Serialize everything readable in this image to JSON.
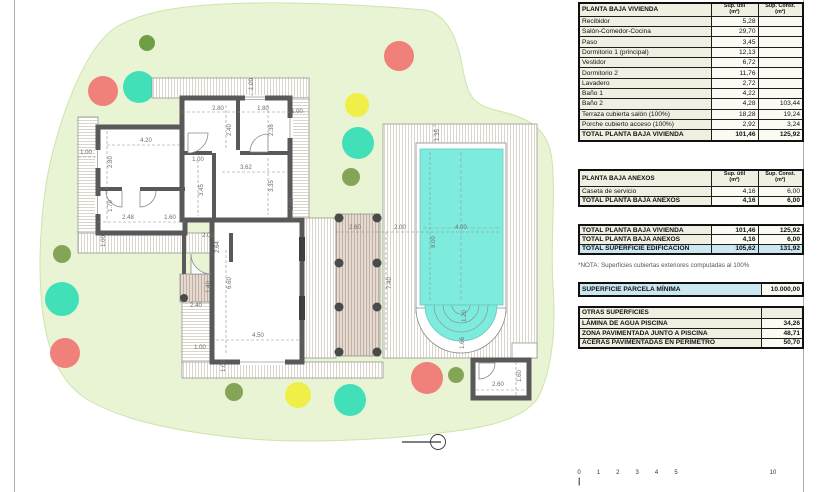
{
  "colors": {
    "site_green": "#e8f4d3",
    "site_edge": "#cfe3ae",
    "wall_gray": "#595959",
    "pool_water": "#7debde",
    "deck_line": "#d8d1c6",
    "pergola_bg": "#e4dad1",
    "pergola_line": "#bdab9e",
    "highlight_blue": "#cbe7f1",
    "table_cream": "#f0efe2",
    "tree_red": "#f0807a",
    "tree_teal": "#41e0b9",
    "tree_yellow": "#f0ee49",
    "tree_olive": "#84a558",
    "tree_olive_dark": "#6f9e45"
  },
  "plan": {
    "dimensions": [
      {
        "t": "1.00",
        "x": 252,
        "y": 84,
        "v": true
      },
      {
        "t": "2.80",
        "x": 218,
        "y": 109,
        "v": false
      },
      {
        "t": "1.80",
        "x": 263,
        "y": 109,
        "v": false
      },
      {
        "t": "1.00",
        "x": 297,
        "y": 112,
        "v": false
      },
      {
        "t": "2.40",
        "x": 230,
        "y": 130,
        "v": true
      },
      {
        "t": "2.38",
        "x": 272,
        "y": 130,
        "v": true
      },
      {
        "t": "4.20",
        "x": 146,
        "y": 141,
        "v": false
      },
      {
        "t": "1.00",
        "x": 86,
        "y": 153,
        "v": false
      },
      {
        "t": "2.80",
        "x": 111,
        "y": 162,
        "v": true
      },
      {
        "t": "1.00",
        "x": 198,
        "y": 160,
        "v": false
      },
      {
        "t": "3.62",
        "x": 246,
        "y": 168,
        "v": false
      },
      {
        "t": "3.45",
        "x": 202,
        "y": 190,
        "v": true
      },
      {
        "t": "3.35",
        "x": 272,
        "y": 186,
        "v": true
      },
      {
        "t": "1.70",
        "x": 111,
        "y": 206,
        "v": true
      },
      {
        "t": "2.48",
        "x": 128,
        "y": 218,
        "v": false
      },
      {
        "t": "1.60",
        "x": 170,
        "y": 218,
        "v": false
      },
      {
        "t": "1.00",
        "x": 292,
        "y": 204,
        "v": true
      },
      {
        "t": "2.00",
        "x": 208,
        "y": 236,
        "v": false
      },
      {
        "t": "2.64",
        "x": 218,
        "y": 247,
        "v": true
      },
      {
        "t": "1.00",
        "x": 104,
        "y": 241,
        "v": true
      },
      {
        "t": "6.60",
        "x": 230,
        "y": 283,
        "v": true
      },
      {
        "t": "1.40",
        "x": 209,
        "y": 287,
        "v": true
      },
      {
        "t": "2.40",
        "x": 196,
        "y": 306,
        "v": false
      },
      {
        "t": "4.50",
        "x": 258,
        "y": 336,
        "v": false
      },
      {
        "t": "1.00",
        "x": 200,
        "y": 348,
        "v": false
      },
      {
        "t": "1.00",
        "x": 224,
        "y": 366,
        "v": true
      },
      {
        "t": "2.60",
        "x": 355,
        "y": 228,
        "v": false
      },
      {
        "t": "2.00",
        "x": 400,
        "y": 228,
        "v": false
      },
      {
        "t": "4.00",
        "x": 461,
        "y": 228,
        "v": false
      },
      {
        "t": "8.00",
        "x": 434,
        "y": 242,
        "v": true
      },
      {
        "t": "7.40",
        "x": 390,
        "y": 283,
        "v": true
      },
      {
        "t": "1.35",
        "x": 438,
        "y": 135,
        "v": true
      },
      {
        "t": "1.20",
        "x": 465,
        "y": 316,
        "v": true
      },
      {
        "t": "1.66",
        "x": 463,
        "y": 343,
        "v": true
      },
      {
        "t": "2.60",
        "x": 498,
        "y": 385,
        "v": false
      },
      {
        "t": "1.60",
        "x": 520,
        "y": 376,
        "v": true
      }
    ],
    "trees": [
      {
        "x": 147,
        "y": 43,
        "r": 8,
        "c": "tree_olive_dark"
      },
      {
        "x": 103,
        "y": 91,
        "r": 15,
        "c": "tree_red"
      },
      {
        "x": 139,
        "y": 87,
        "r": 16,
        "c": "tree_teal"
      },
      {
        "x": 399,
        "y": 56,
        "r": 15,
        "c": "tree_red"
      },
      {
        "x": 357,
        "y": 105,
        "r": 12,
        "c": "tree_yellow"
      },
      {
        "x": 358,
        "y": 143,
        "r": 16,
        "c": "tree_teal"
      },
      {
        "x": 351,
        "y": 177,
        "r": 9,
        "c": "tree_olive"
      },
      {
        "x": 62,
        "y": 254,
        "r": 9,
        "c": "tree_olive"
      },
      {
        "x": 62,
        "y": 299,
        "r": 17,
        "c": "tree_teal"
      },
      {
        "x": 65,
        "y": 353,
        "r": 15,
        "c": "tree_red"
      },
      {
        "x": 234,
        "y": 392,
        "r": 9,
        "c": "tree_olive"
      },
      {
        "x": 298,
        "y": 395,
        "r": 13,
        "c": "tree_yellow"
      },
      {
        "x": 350,
        "y": 400,
        "r": 16,
        "c": "tree_teal"
      },
      {
        "x": 427,
        "y": 378,
        "r": 16,
        "c": "tree_red"
      },
      {
        "x": 456,
        "y": 375,
        "r": 8,
        "c": "tree_olive"
      }
    ],
    "scale_bar": {
      "labels": [
        "0",
        "1",
        "2",
        "3",
        "4",
        "5",
        "10"
      ],
      "positions": [
        0,
        1,
        2,
        3,
        4,
        5,
        10
      ]
    }
  },
  "tables": {
    "col_util": "Sup. útil\n(m²)",
    "col_const": "Sup. Const.\n(m²)",
    "vivienda": {
      "title": "PLANTA BAJA VIVIENDA",
      "rows": [
        [
          "Recibidor",
          "5,28",
          ""
        ],
        [
          "Salón-Comedor-Cocina",
          "29,70",
          ""
        ],
        [
          "Paso",
          "3,45",
          ""
        ],
        [
          "Dormitorio 1 (principal)",
          "12,13",
          ""
        ],
        [
          "Vestidor",
          "6,72",
          ""
        ],
        [
          "Dormitorio 2",
          "11,76",
          ""
        ],
        [
          "Lavadero",
          "2,72",
          ""
        ],
        [
          "Baño 1",
          "4,22",
          ""
        ],
        [
          "Baño 2",
          "4,28",
          "103,44"
        ],
        [
          "Terraza cubierta salón (100%)",
          "18,28",
          "19,24"
        ],
        [
          "Porche cubierto acceso (100%)",
          "2,92",
          "3,24"
        ]
      ],
      "total": [
        "TOTAL PLANTA BAJA VIVIENDA",
        "101,46",
        "125,92"
      ]
    },
    "anexos": {
      "title": "PLANTA BAJA ANEXOS",
      "rows": [
        [
          "Caseta de servicio",
          "4,16",
          "6,00"
        ]
      ],
      "total": [
        "TOTAL PLANTA BAJA ANEXOS",
        "4,16",
        "6,00"
      ]
    },
    "resumen": {
      "rows": [
        {
          "cells": [
            "TOTAL PLANTA BAJA VIVIENDA",
            "101,46",
            "125,92"
          ],
          "blue": false
        },
        {
          "cells": [
            "TOTAL PLANTA BAJA ANEXOS",
            "4,16",
            "6,00"
          ],
          "blue": false
        },
        {
          "cells": [
            "TOTAL SUPERFICIE EDIFICACIÓN",
            "105,62",
            "131,92"
          ],
          "blue": true
        }
      ]
    },
    "nota": "*NOTA: Superficies cubiertas exteriores computadas al 100%",
    "parcela": {
      "label": "SUPERFICIE PARCELA MÍNIMA",
      "value": "10.000,00"
    },
    "otras": {
      "title": "OTRAS SUPERFICIES",
      "rows": [
        [
          "LÁMINA DE AGUA PISCINA",
          "34,26"
        ],
        [
          "ZONA PAVIMENTADA JUNTO A PISCINA",
          "48,71"
        ],
        [
          "ACERAS PAVIMENTADAS EN PERÍMETRO",
          "50,70"
        ]
      ]
    }
  }
}
